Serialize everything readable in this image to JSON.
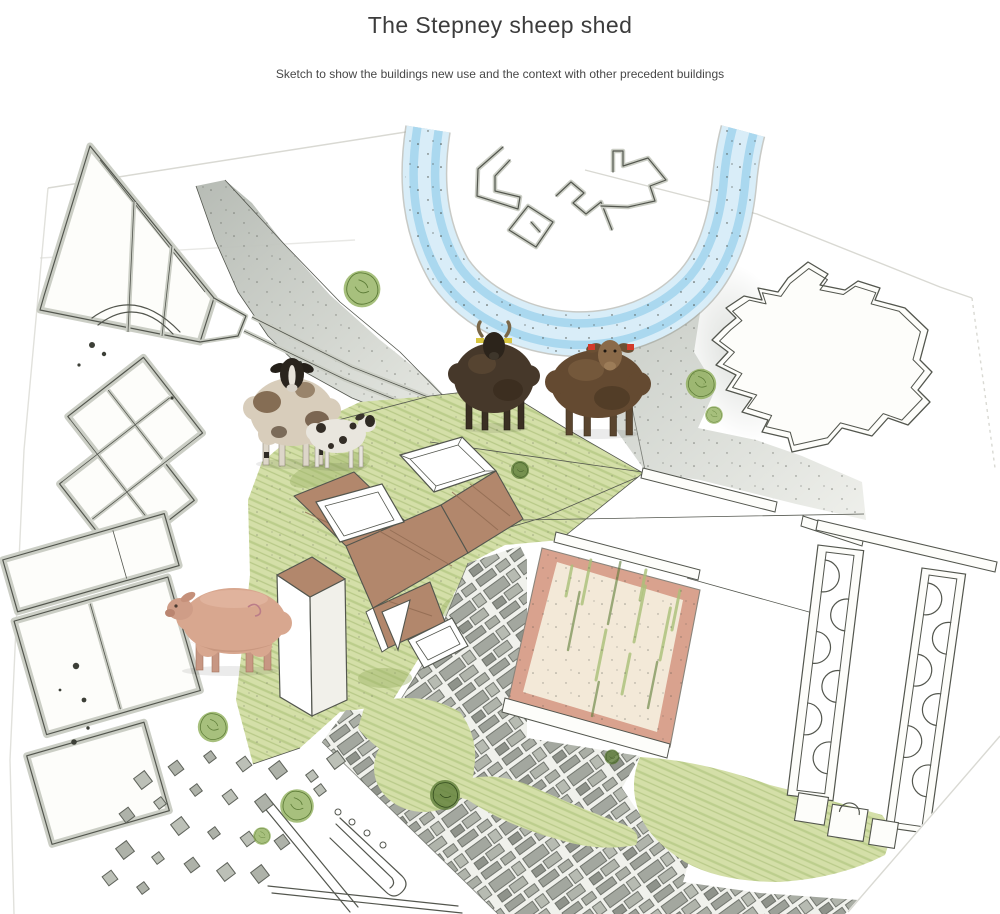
{
  "page": {
    "title": "The Stepney sheep shed",
    "subtitle": "Sketch to show the buildings new use and the context with other precedent buildings"
  },
  "colors": {
    "title_text": "#3c3c3c",
    "subtitle_text": "#474747",
    "pencil": "#53564e",
    "wall_fill": "#fdfdfa",
    "wall_gray": "#cbcec5",
    "road_gray": "#b3b8b1",
    "road_gray_light": "#e8eae4",
    "river_blue": "#9fd2ec",
    "river_blue_light": "#d8edf8",
    "grass": "#d4dfa8",
    "grass_stroke": "#aac178",
    "grass_dark": "#9db469",
    "tree_green": "#8aab52",
    "tree_dark": "#5e7d38",
    "roof": "#b2876c",
    "roof_line": "#8f6950",
    "field_pink": "#d9a28e",
    "field_cream": "#f3e9d8",
    "paper_edge": "#d9d9d3",
    "ink": "#3c3f37",
    "sheep_cream": "#d8cdbb",
    "sheep_white": "#e9e6de",
    "sheep_dark": "#46382a",
    "sheep_brown": "#644a31",
    "sheep_pink": "#d8a78f",
    "tag_red": "#d23b2c",
    "tag_yellow": "#d8c640"
  }
}
